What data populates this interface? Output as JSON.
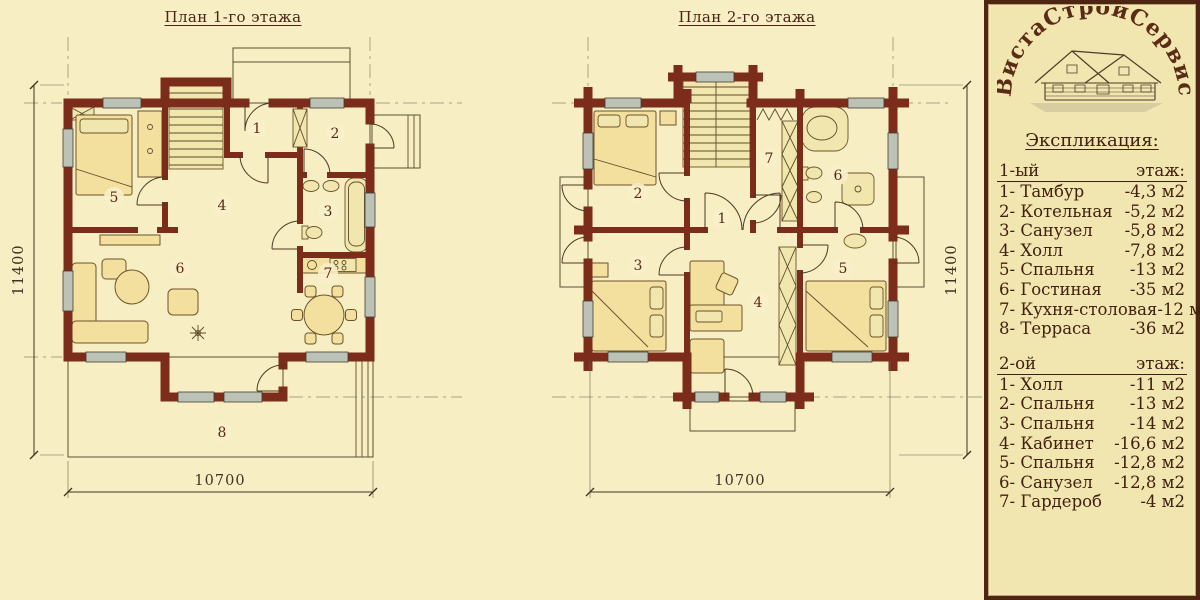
{
  "colors": {
    "background": "#f8eec4",
    "panel_background": "#f2e6b0",
    "wall": "#7b2c1a",
    "text": "#40200f",
    "floor_stripe": "#eee1a5",
    "deck_stripe": "#e7d793"
  },
  "plan1": {
    "title": "План 1-го этажа",
    "dim_bottom": "10700",
    "dim_side": "11400",
    "rooms": [
      "1",
      "2",
      "3",
      "4",
      "5",
      "6",
      "7",
      "8"
    ]
  },
  "plan2": {
    "title": "План 2-го этажа",
    "dim_bottom": "10700",
    "dim_side": "11400",
    "rooms": [
      "1",
      "2",
      "3",
      "4",
      "5",
      "6",
      "7"
    ]
  },
  "legend": {
    "logo_text": "ВистаСтройСервис",
    "heading": "Экспликация:",
    "sections": [
      {
        "floor_label": "1-ый",
        "floor_suffix": "этаж:",
        "items": [
          {
            "name": "1- Тамбур",
            "area": "-4,3 м2"
          },
          {
            "name": "2- Котельная",
            "area": "-5,2 м2"
          },
          {
            "name": "3- Санузел",
            "area": "-5,8 м2"
          },
          {
            "name": "4- Холл",
            "area": "-7,8 м2"
          },
          {
            "name": "5- Спальня",
            "area": "-13 м2"
          },
          {
            "name": "6- Гостиная",
            "area": "-35 м2"
          },
          {
            "name": "7- Кухня-столовая",
            "area": "-12 м2"
          },
          {
            "name": "8- Терраса",
            "area": "-36 м2"
          }
        ]
      },
      {
        "floor_label": "2-ой",
        "floor_suffix": "этаж:",
        "items": [
          {
            "name": "1- Холл",
            "area": "-11 м2"
          },
          {
            "name": "2- Спальня",
            "area": "-13 м2"
          },
          {
            "name": "3- Спальня",
            "area": "-14 м2"
          },
          {
            "name": "4- Кабинет",
            "area": "-16,6 м2"
          },
          {
            "name": "5- Спальня",
            "area": "-12,8 м2"
          },
          {
            "name": "6- Санузел",
            "area": "-12,8 м2"
          },
          {
            "name": "7- Гардероб",
            "area": "-4 м2"
          }
        ]
      }
    ]
  }
}
